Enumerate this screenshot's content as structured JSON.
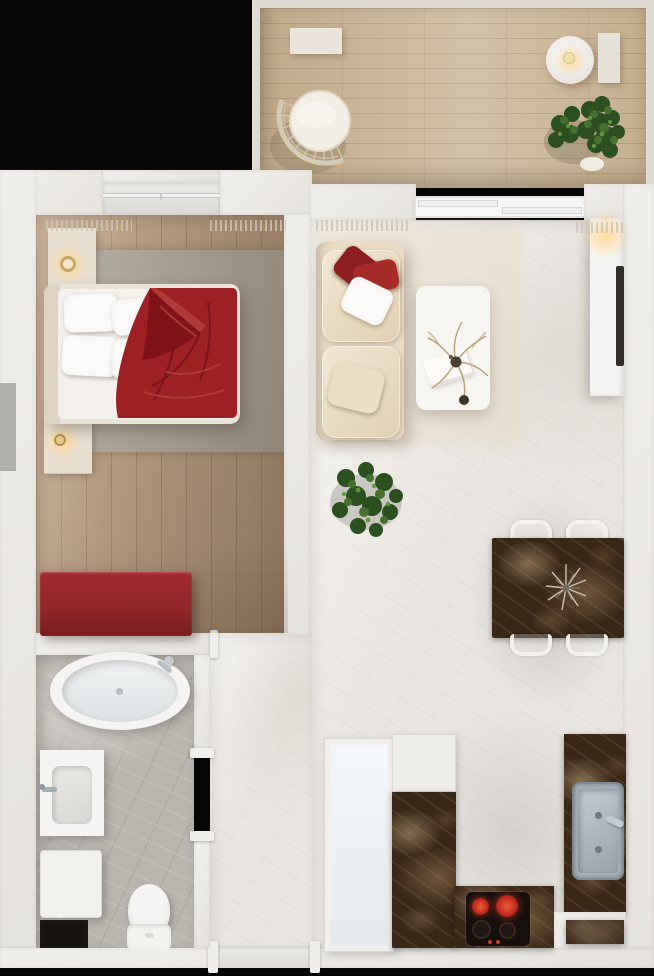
{
  "scene": {
    "kind": "3d-apartment-floor-plan-top-view",
    "width_px": 654,
    "height_px": 976,
    "rooms": {
      "balcony": {
        "label": "balcony",
        "floor": "light wood planks",
        "furniture": [
          "wall-shelf",
          "round-side-table",
          "lit-candle",
          "fan-wicker-lounge-chair",
          "potted-plant",
          "storage-bench"
        ]
      },
      "bedroom": {
        "label": "bedroom",
        "floor": "wood planks",
        "furniture": [
          "double-bed",
          "headboard",
          "white-pillows-x4",
          "red-duvet",
          "nightstand-with-lamp-top",
          "nightstand-with-lamp-bottom",
          "gray-area-rug",
          "red-dresser-bench",
          "window",
          "curtain-fringes"
        ]
      },
      "living_dining": {
        "label": "living-dining area",
        "floor": "white marble",
        "furniture": [
          "cream-sofa",
          "red-throw-pillows-x2",
          "white-throw-pillow",
          "cream-throw-pillow",
          "white-coffee-table",
          "decor-branches",
          "book",
          "floor-plant",
          "tv-cabinet-with-light",
          "tv-panel",
          "balcony-sliding-door",
          "dark-marble-dining-table",
          "dining-chairs-x4",
          "silver-centerpiece"
        ]
      },
      "kitchen": {
        "label": "kitchen",
        "floor": "white marble",
        "furniture": [
          "dark-marble-counter-left",
          "dark-marble-counter-bottom",
          "dark-marble-counter-right",
          "white-cabinet",
          "induction-cooktop",
          "hot-burners-x2",
          "cold-burners-x2",
          "steel-sink-with-faucet",
          "marble-window-niche"
        ]
      },
      "bathroom": {
        "label": "bathroom",
        "floor": "gray marble",
        "furniture": [
          "oval-bathtub",
          "tub-faucet",
          "vanity-with-sink",
          "sink-faucet",
          "washing-machine",
          "toilet",
          "dark-storage-niche"
        ]
      },
      "hallway": {
        "label": "entry hall",
        "floor": "white marble",
        "furniture": [
          "built-in-wardrobe",
          "entry-threshold",
          "bathroom-door-opening",
          "bedroom-door-opening"
        ]
      }
    }
  },
  "palette": {
    "background_black": "#060606",
    "wall": "#f1efeb",
    "wall_shade": "#dbd8d3",
    "rail_light": "#dfdbd3",
    "wood_balcony": "#cdb897",
    "wood_bedroom": "#b2987b",
    "marble_light": "#e9e5e0",
    "floor_bath": "#b9b5af",
    "rug_bedroom": "#a29a8f",
    "rug_living": "#e8ddc9",
    "bed_linen_white": "#f4f1ec",
    "duvet_red": "#9d2023",
    "duvet_fold_dark": "#7a1215",
    "duvet_highlight": "#b5423b",
    "dresser_red": "#9c2528",
    "sofa_cream": "#e9dcc3",
    "pillow_red": "#8e1d20",
    "pillow_red_bright": "#a62a28",
    "table_white": "#f8f6f2",
    "counter_dark_marble": "#3a2817",
    "cabinet_white": "#f0eeea",
    "wardrobe_white": "#f2f0ec",
    "cooktop_black": "#15100d",
    "burner_red": "#c0281c",
    "steel": "#a8b2bb",
    "fixture_white": "#f5f4f2",
    "plant_dark": "#2b4f1e",
    "plant_mid": "#447130",
    "plant_light": "#62973f",
    "glow_warm": "#ffd896",
    "wicker": "#cfc4ab",
    "sill_gray": "#b2b0ad"
  }
}
